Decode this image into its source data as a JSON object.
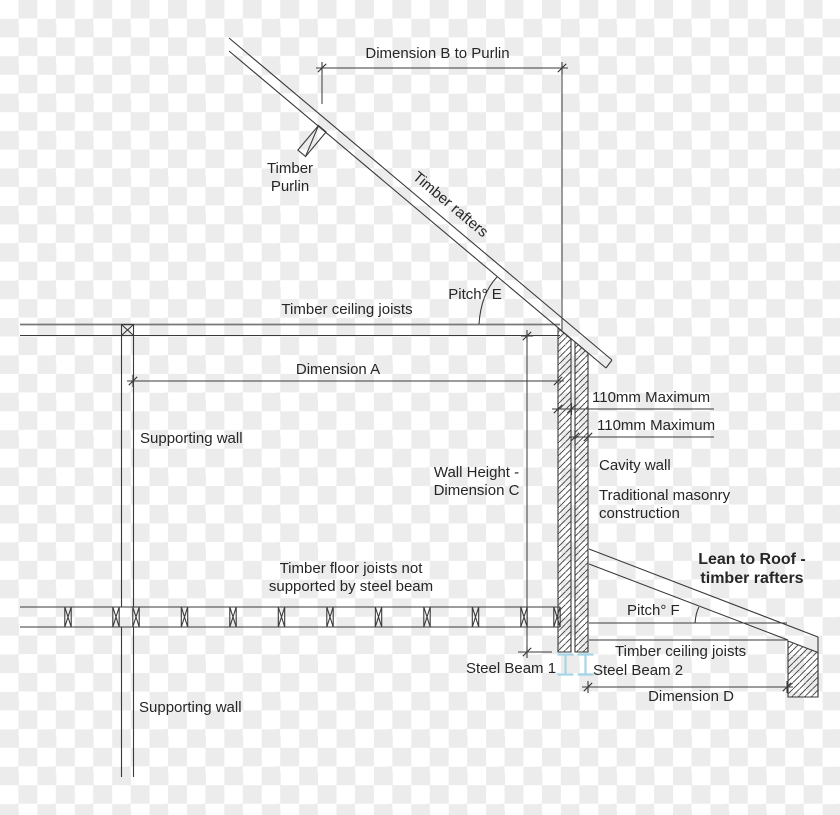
{
  "colors": {
    "line": "#3a3a3a",
    "steel_beam": "#a5d5e6",
    "checker": "#ececec",
    "text": "#262626"
  },
  "labels": {
    "dimension_b": "Dimension B to Purlin",
    "timber_purlin": "Timber\nPurlin",
    "timber_rafters": "Timber rafters",
    "pitch_e": "Pitch° E",
    "timber_ceiling_joists": "Timber ceiling joists",
    "dimension_a": "Dimension A",
    "supporting_wall_upper": "Supporting wall",
    "wall_height": "Wall Height -\nDimension C",
    "max_110_upper": "110mm Maximum",
    "max_110_lower": "110mm Maximum",
    "cavity_wall": "Cavity wall",
    "masonry": "Traditional masonry\nconstruction",
    "lean_to_roof": "Lean to Roof -\ntimber rafters",
    "floor_joists": "Timber floor joists not\nsupported by steel beam",
    "pitch_f": "Pitch° F",
    "timber_ceiling_joists_lean": "Timber ceiling joists",
    "steel_beam_1": "Steel Beam 1",
    "steel_beam_2": "Steel Beam 2",
    "dimension_d": "Dimension D",
    "supporting_wall_lower": "Supporting wall"
  }
}
